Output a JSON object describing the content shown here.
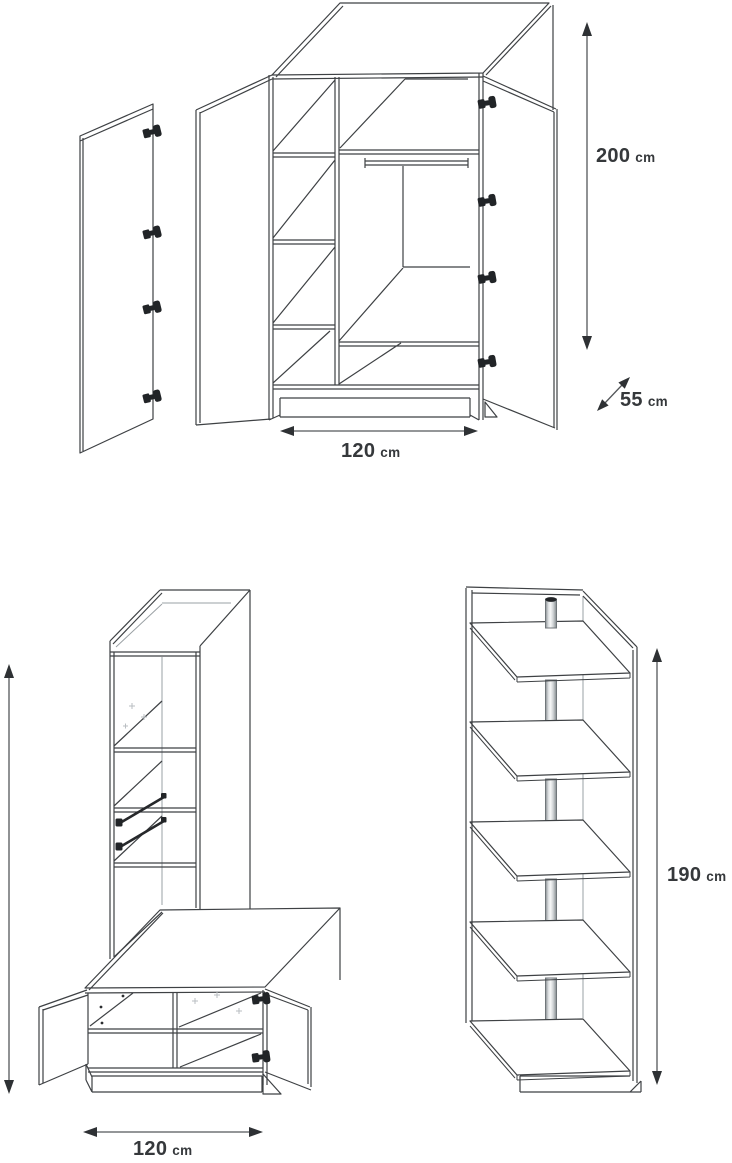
{
  "colors": {
    "background": "#ffffff",
    "line": "#3e4144",
    "light_line": "#9aa0a4",
    "dimension_line": "#54575a",
    "arrowhead": "#2e3134",
    "label_text": "#35383b",
    "hardware": "#212427",
    "pole_edge": "#878d91",
    "pole_highlight": "#f7f8f8"
  },
  "items": {
    "wardrobe": {
      "height": {
        "value": "200",
        "unit": "cm"
      },
      "depth": {
        "value": "55",
        "unit": "cm"
      },
      "width": {
        "value": "120",
        "unit": "cm"
      }
    },
    "hall_unit": {
      "width": {
        "value": "120",
        "unit": "cm"
      }
    },
    "corner_shelf": {
      "height": {
        "value": "190",
        "unit": "cm"
      }
    }
  }
}
